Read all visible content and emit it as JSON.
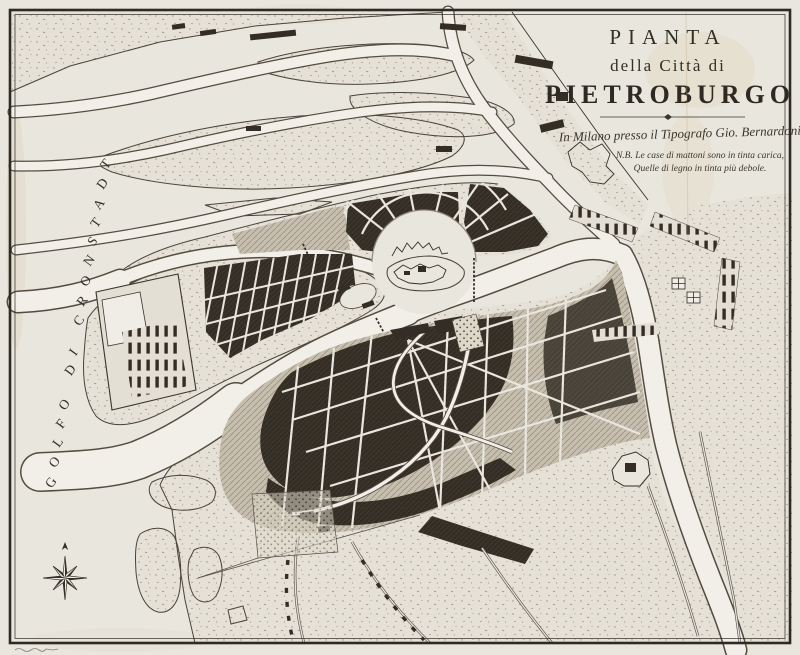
{
  "map": {
    "title": {
      "line1": "PIANTA",
      "line2": "della Città di",
      "line3": "PIETROBURGO"
    },
    "imprint": "In Milano presso il Tipografo Gio. Bernardoni",
    "note": {
      "line1": "N.B. Le case di mattoni sono in tinta carica,",
      "line2": "Quelle di legno in tinta più debole."
    },
    "labels": {
      "gulf": "GOLFO DI CRONSTADT"
    },
    "icons": {
      "compass": "compass-rose-icon"
    },
    "colors": {
      "paper": "#e9e6de",
      "ink": "#332e26",
      "water": "#f1efe8",
      "coastline": "#4a433a",
      "brick_blocks_dark": "#332d25",
      "wood_blocks_light": "#c3bbad"
    }
  }
}
